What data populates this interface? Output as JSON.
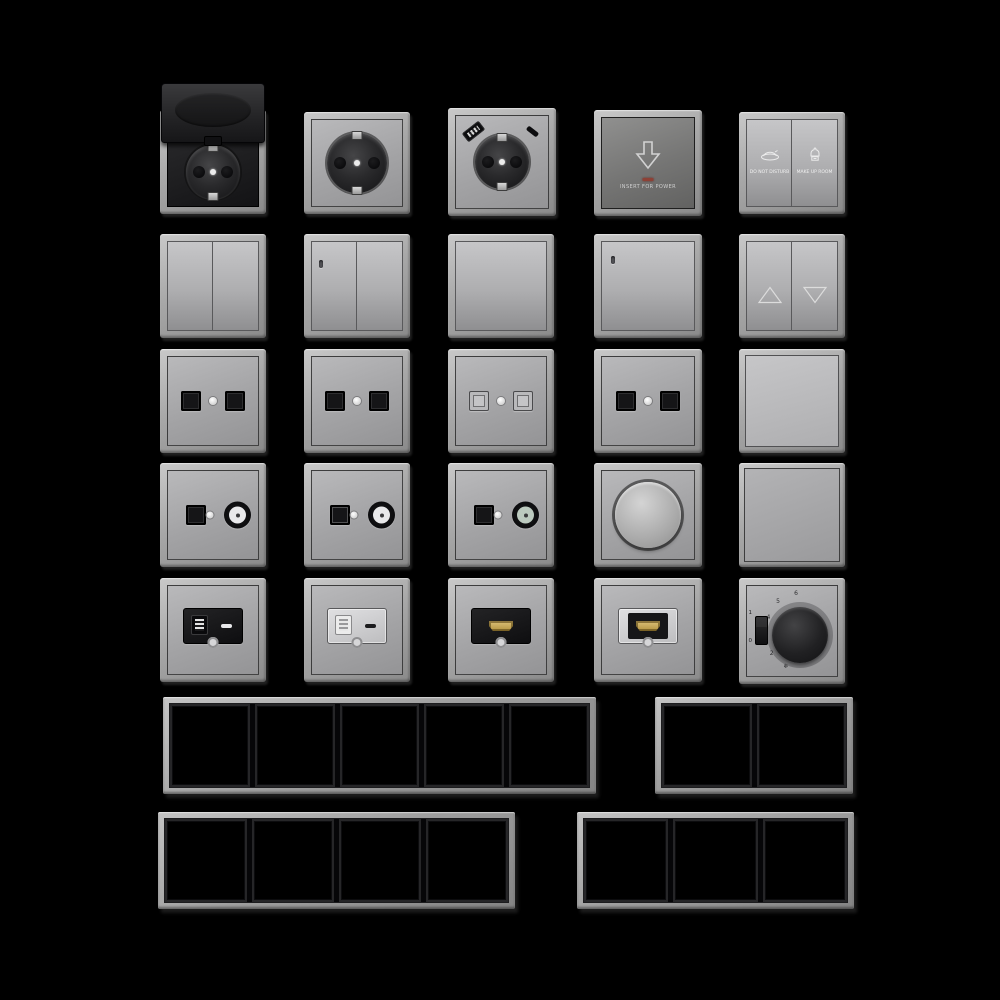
{
  "scene": {
    "background": "#000000",
    "width": 1000,
    "height": 1000,
    "description": "Product grid of modular wall switches, sockets, dimmers, media outlets, thermostat and multi-gang cover frames rendered on a black background"
  },
  "colors": {
    "background": "#000000",
    "frame_grey": "#b0b0b2",
    "plate_grey": "#a6a6a8",
    "dark_plate": "#757574",
    "black_module": "#161618",
    "led_red": "#8d4136",
    "hdmi_gold": "#c9a95e",
    "coax_white": "#e9e9eb",
    "coax_green": "#bccabf"
  },
  "items": [
    {
      "name": "schuko-socket-hinged-lid",
      "kind": "socket-lid",
      "x": 160,
      "y": 110,
      "w": 106,
      "h": 104
    },
    {
      "name": "schuko-socket",
      "kind": "socket",
      "x": 304,
      "y": 112,
      "w": 106,
      "h": 102
    },
    {
      "name": "schuko-socket-usb",
      "kind": "socket-usb",
      "x": 448,
      "y": 108,
      "w": 108,
      "h": 108
    },
    {
      "name": "key-card-power-switch",
      "kind": "card-switch",
      "x": 594,
      "y": 110,
      "w": 108,
      "h": 106,
      "caption": "INSERT FOR POWER"
    },
    {
      "name": "hotel-service-switch",
      "kind": "hotel",
      "x": 739,
      "y": 112,
      "w": 106,
      "h": 102,
      "left_label": "DO NOT DISTURB",
      "right_label": "MAKE UP ROOM"
    },
    {
      "name": "double-rocker-switch",
      "kind": "rocker2",
      "x": 160,
      "y": 234,
      "w": 106,
      "h": 104
    },
    {
      "name": "double-rocker-switch-indicator",
      "kind": "rocker2-led",
      "x": 304,
      "y": 234,
      "w": 106,
      "h": 104
    },
    {
      "name": "single-rocker-switch",
      "kind": "rocker1",
      "x": 448,
      "y": 234,
      "w": 106,
      "h": 104
    },
    {
      "name": "single-rocker-switch-indicator",
      "kind": "rocker1-led",
      "x": 594,
      "y": 234,
      "w": 108,
      "h": 104
    },
    {
      "name": "shutter-blind-switch",
      "kind": "blind",
      "x": 739,
      "y": 234,
      "w": 106,
      "h": 104
    },
    {
      "name": "dual-data-socket-a",
      "kind": "data2",
      "x": 160,
      "y": 349,
      "w": 106,
      "h": 104
    },
    {
      "name": "dual-data-socket-b",
      "kind": "data2",
      "x": 304,
      "y": 349,
      "w": 106,
      "h": 104
    },
    {
      "name": "dual-data-socket-shuttered",
      "kind": "data2-light",
      "x": 448,
      "y": 349,
      "w": 106,
      "h": 104
    },
    {
      "name": "dual-data-socket-c",
      "kind": "data2",
      "x": 594,
      "y": 349,
      "w": 108,
      "h": 104
    },
    {
      "name": "flat-push-switch",
      "kind": "flat-switch",
      "x": 739,
      "y": 349,
      "w": 106,
      "h": 104
    },
    {
      "name": "tv-data-combo-socket-a",
      "kind": "tv-data",
      "x": 160,
      "y": 463,
      "w": 106,
      "h": 104,
      "coax_center": "#e9e9eb"
    },
    {
      "name": "tv-data-combo-socket-b",
      "kind": "tv-data",
      "x": 304,
      "y": 463,
      "w": 106,
      "h": 104,
      "coax_center": "#e9e9eb",
      "port_variant": "framed"
    },
    {
      "name": "tv-data-combo-socket-c",
      "kind": "tv-data",
      "x": 448,
      "y": 463,
      "w": 106,
      "h": 104,
      "coax_center": "#bccabf"
    },
    {
      "name": "rotary-dimmer",
      "kind": "dimmer",
      "x": 594,
      "y": 463,
      "w": 108,
      "h": 104
    },
    {
      "name": "blank-cover",
      "kind": "blank",
      "x": 739,
      "y": 463,
      "w": 106,
      "h": 104
    },
    {
      "name": "usb-charger-socket-black",
      "kind": "usbmod",
      "x": 160,
      "y": 578,
      "w": 106,
      "h": 104,
      "variant": "dark"
    },
    {
      "name": "usb-charger-socket-silver",
      "kind": "usbmod",
      "x": 304,
      "y": 578,
      "w": 106,
      "h": 104,
      "variant": "light"
    },
    {
      "name": "hdmi-socket-black",
      "kind": "hdmimod",
      "x": 448,
      "y": 578,
      "w": 106,
      "h": 104,
      "variant": "dark"
    },
    {
      "name": "hdmi-socket-silver",
      "kind": "hdmimod",
      "x": 594,
      "y": 578,
      "w": 108,
      "h": 104,
      "variant": "light"
    },
    {
      "name": "room-thermostat",
      "kind": "thermostat",
      "x": 739,
      "y": 578,
      "w": 106,
      "h": 106,
      "scale": [
        "6",
        "5",
        "4",
        "3",
        "2",
        "❄"
      ],
      "switch_labels": [
        "1",
        "0"
      ]
    }
  ],
  "frames": [
    {
      "name": "cover-frame-5-gang",
      "gangs": 5,
      "x": 163,
      "y": 697,
      "w": 433,
      "h": 97
    },
    {
      "name": "cover-frame-2-gang",
      "gangs": 2,
      "x": 655,
      "y": 697,
      "w": 198,
      "h": 97
    },
    {
      "name": "cover-frame-4-gang",
      "gangs": 4,
      "x": 158,
      "y": 812,
      "w": 357,
      "h": 97
    },
    {
      "name": "cover-frame-3-gang",
      "gangs": 3,
      "x": 577,
      "y": 812,
      "w": 277,
      "h": 97
    }
  ]
}
